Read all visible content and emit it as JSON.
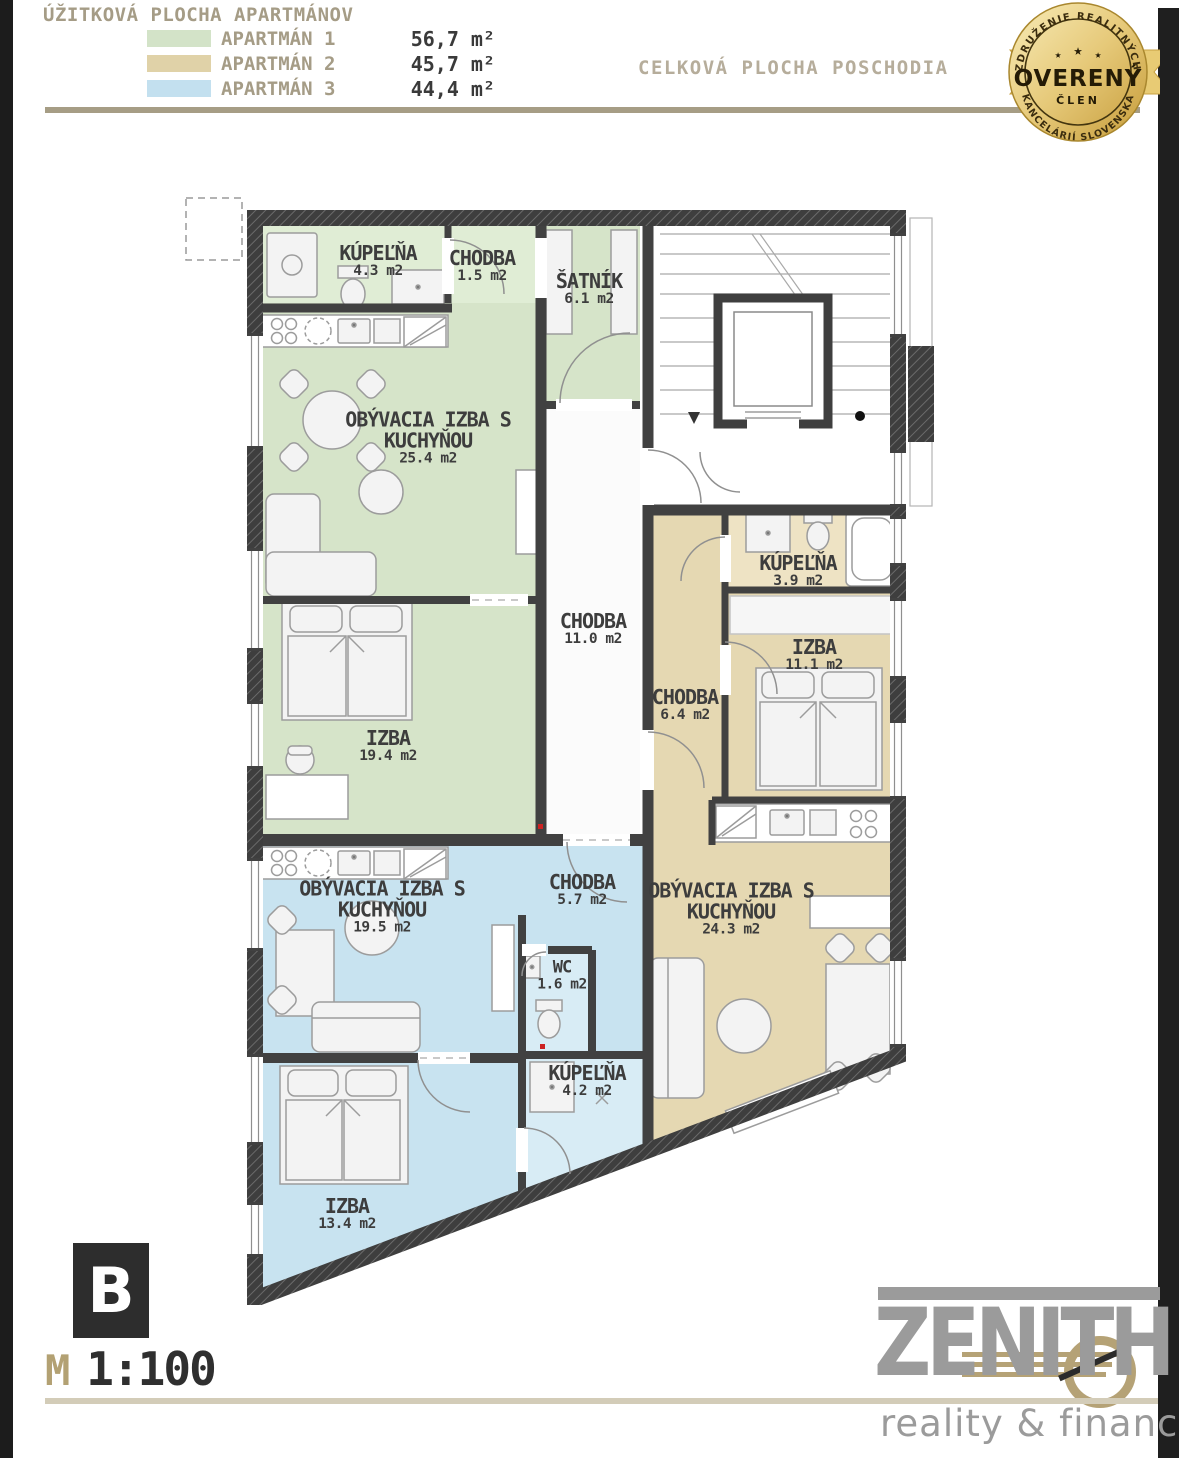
{
  "legend": {
    "title": "ÚŽITKOVÁ PLOCHA APARTMÁNOV",
    "items": [
      {
        "label": "APARTMÁN 1",
        "area": "56,7 m²",
        "color": "#d3e3c8"
      },
      {
        "label": "APARTMÁN 2",
        "area": "45,7 m²",
        "color": "#e0d2a8"
      },
      {
        "label": "APARTMÁN 3",
        "area": "44,4 m²",
        "color": "#c3e0ef"
      }
    ]
  },
  "header": {
    "total_label": "CELKOVÁ PLOCHA POSCHODIA"
  },
  "badge": {
    "top_text": "ZDRUŽENIE REALITNÝCH",
    "main": "OVERENÝ",
    "sub": "ČLEN",
    "bottom_text": "KANCELÁRIÍ SLOVENSKA",
    "star": "★",
    "gold": "#d4ac4e"
  },
  "floorplan": {
    "scale_note": "1:100",
    "colors": {
      "green": "#d6e4c9",
      "green_light": "#e0edd5",
      "tan": "#e5d8b2",
      "tan_light": "#eee3c4",
      "blue": "#c8e3f0",
      "blue_light": "#d8ecf5",
      "corridor": "#fbfbfb",
      "stairwell": "#ffffff",
      "wall": "#414141"
    },
    "rooms": [
      {
        "name": "KÚPEĽŇA",
        "area": "4.3 m2",
        "apartment": "1"
      },
      {
        "name": "CHODBA",
        "area": "1.5 m2",
        "apartment": "1"
      },
      {
        "name": "ŠATNÍK",
        "area": "6.1 m2",
        "apartment": "1"
      },
      {
        "name": "OBÝVACIA IZBA S KUCHYŇOU",
        "area": "25.4 m2",
        "apartment": "1"
      },
      {
        "name": "IZBA",
        "area": "19.4 m2",
        "apartment": "1"
      },
      {
        "name": "CHODBA",
        "area": "11.0 m2",
        "apartment": "common"
      },
      {
        "name": "KÚPEĽŇA",
        "area": "3.9 m2",
        "apartment": "2"
      },
      {
        "name": "IZBA",
        "area": "11.1 m2",
        "apartment": "2"
      },
      {
        "name": "CHODBA",
        "area": "6.4 m2",
        "apartment": "2"
      },
      {
        "name": "OBÝVACIA IZBA S KUCHYŇOU",
        "area": "24.3 m2",
        "apartment": "2"
      },
      {
        "name": "OBÝVACIA IZBA S KUCHYŇOU",
        "area": "19.5 m2",
        "apartment": "3"
      },
      {
        "name": "CHODBA",
        "area": "5.7 m2",
        "apartment": "3"
      },
      {
        "name": "WC",
        "area": "1.6 m2",
        "apartment": "3"
      },
      {
        "name": "KÚPEĽŇA",
        "area": "4.2 m2",
        "apartment": "3"
      },
      {
        "name": "IZBA",
        "area": "13.4 m2",
        "apartment": "3"
      }
    ]
  },
  "footer": {
    "section_letter": "B",
    "scale_prefix": "M",
    "scale_value": "1:100",
    "brand": "ZENITH",
    "brand_sub": "reality & finance"
  }
}
